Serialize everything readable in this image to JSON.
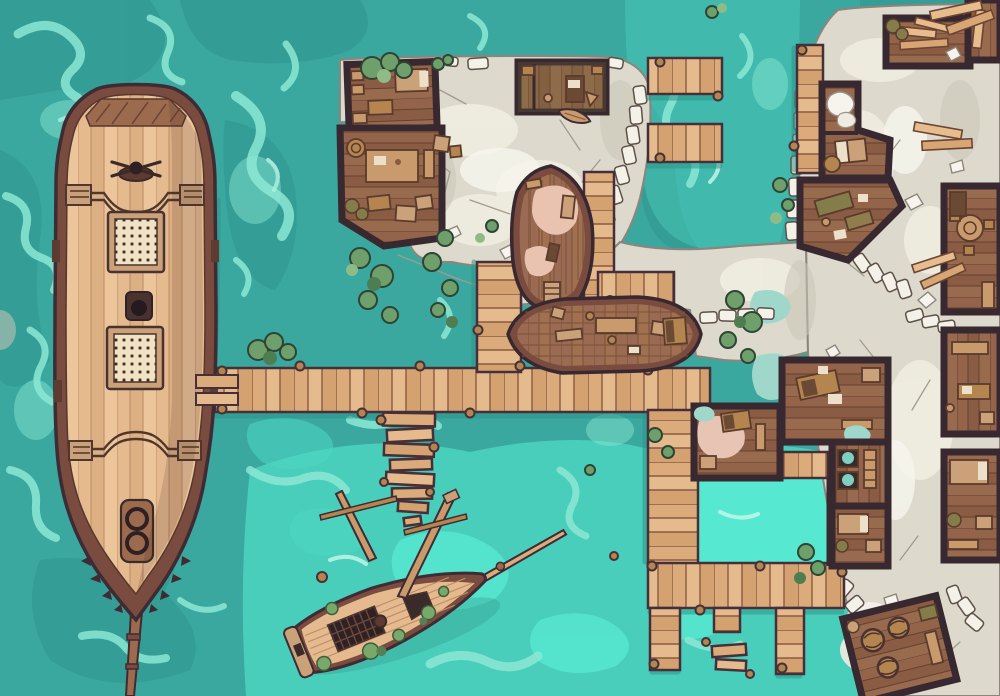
{
  "scene": {
    "title": "Tropical Harbor Docks — top-down battle map",
    "style": "hand-drawn tabletop RPG map, no text or UI overlays",
    "view": "top-down",
    "canvas": {
      "width": 1000,
      "height": 696
    }
  },
  "palette": {
    "water_base": "#3aa89f",
    "water_dark": "#2f938c",
    "water_bright": "#4ed8c3",
    "water_lagoon": "#57e8d2",
    "foam": "#8ce8d4",
    "foam_light": "#c9f7ec",
    "shadow_water": "#2e9389",
    "dock_plank": "#dcab7c",
    "dock_plank_light": "#e5bb8d",
    "dock_plank_dark": "#d4a271",
    "dock_seam": "#8a5a40",
    "dock_outline": "#45303a",
    "ship_rim": "#7a4b3f",
    "ship_deck": "#e4ba8e",
    "ship_deck_dark": "#ddb083",
    "ship_deck_light": "#ecc59a",
    "deck_seam": "#c09068",
    "ship_outline": "#3f2b33",
    "hull_int": "#9a6b52",
    "hull_int_2": "#a07050",
    "hull_seam": "#7a5238",
    "pink_deck": "#e9c2b0",
    "pink_floor": "#e8c4b4",
    "wall": "#382830",
    "floor_a": "#936449",
    "floor_b": "#8a5c43",
    "floor_c": "#996b4e",
    "floor_seam": "#64402f",
    "floor_olive": "#6e6a3c",
    "furn_tan": "#c89a6c",
    "furn_mid": "#b5854f",
    "furn_dark": "#6b4a33",
    "furn_light": "#caa178",
    "paper": "#ece0cb",
    "stone": "#ddd9cc",
    "stone_light": "#efece1",
    "stone_bright": "#f6f4ec",
    "stone_shadow": "#c9c5b7",
    "stone_edge": "#8d857c",
    "stone_crack": "#a29b8e",
    "block_fill": "#f4f1e8",
    "block_edge": "#5d5148",
    "leaf_dark": "#4f7d52",
    "leaf_mid": "#6fa06c",
    "leaf_light": "#8fbb86",
    "leaf_edge": "#2e4434",
    "moss": "#7aa86a",
    "olive_sack": "#857d49",
    "dark_item": "#3a2a28",
    "teal_puddle": "#9fd8cb",
    "grate_bg": "#f0e2c2"
  },
  "features": {
    "ocean": "Turquoise sea with foam swirls and bright shallows",
    "large_ship": "Large sailing ship moored beside the main pier, deck with two grated hatches, capstan and rope coil, bowsprit pointing south",
    "gangplanks": "Two boarding planks between ship and pier",
    "main_dock": "Main plank pier running east from the ship",
    "walkway_dock": "North plank walkway up to the slipway",
    "dock_column": "South pier toward the flooded quarter",
    "lower_dock": "East-west pier along the flooded basin",
    "pier_stubs": "Short mooring finger stubs and floating planks",
    "north_piers": "Twin mooring fingers on the north quay",
    "northeast_dock": "Quay-side dock strip on the northeast shore",
    "rickety_dock": "Broken narrow dock leading down to the wreck",
    "shipwreck": "Half-sunken wreck with fallen masts, open holds and moss",
    "hull_building_vertical": "Boat hull on the slipway (bow north) used as a work floor",
    "hull_building_horizontal": "Boat hull workshop lying east-west with work tables",
    "plaza": "Paved stone quay plaza",
    "stone_quarter": "Paved stone quarter along the east side",
    "warehouse_l": "L-shaped dockside house with beds, tables and crates",
    "office_north": "Harbor office with desk and stools",
    "lumber_room": "Lumber storage room with stacked planks and sacks",
    "angled_house": "Angled two-room house with bed, sails and barrel",
    "angled_hall": "Angled work hall with olive work tables",
    "cluster_rooms": "Warehouse block with pink floor patch, basins and desks",
    "lagoon": "Bright flooded basin enclosed by piers",
    "right_rooms": "Row of rooms along the east edge (round table, bench room, bedroom)",
    "barrel_room": "Tilted storeroom full of barrels at the south-east",
    "vegetation": "Green shrubs, vines and moss clumps",
    "lumber_piles": "Loose stacked lumber on the stone",
    "stone_walls": "Low white stone-block wall chains",
    "small_boat": "Tiny rowboat pulled up on the plaza"
  }
}
